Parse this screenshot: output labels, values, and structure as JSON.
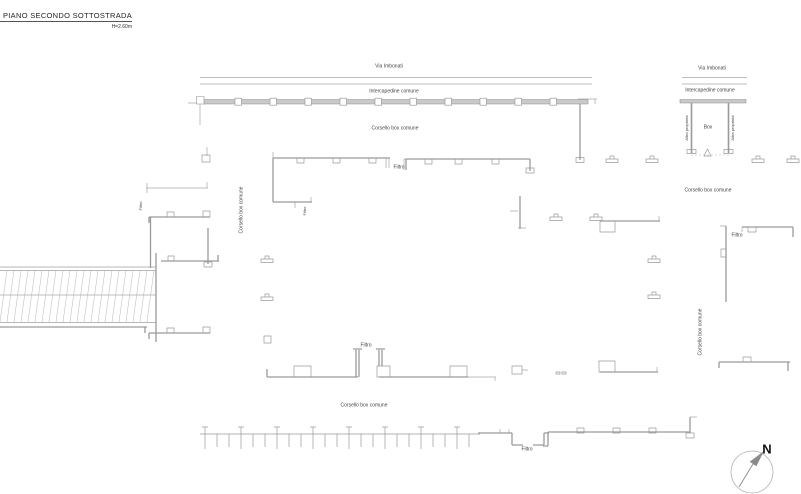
{
  "title": {
    "text": "PIANO SECONDO SOTTOSTRADA",
    "height_note": "H=2.60m"
  },
  "labels": {
    "via_imbonati": "Via Imbonati",
    "intercapedine": "Intercapedine comune",
    "corsello": "Corsello box comune",
    "filtro": "Filtro",
    "box": "Box",
    "altra_proprieta": "Altra proprietà",
    "north": "N"
  },
  "colors": {
    "line": "#9a9a9a",
    "wall_fill": "#c9c9c9",
    "text": "#444444"
  }
}
